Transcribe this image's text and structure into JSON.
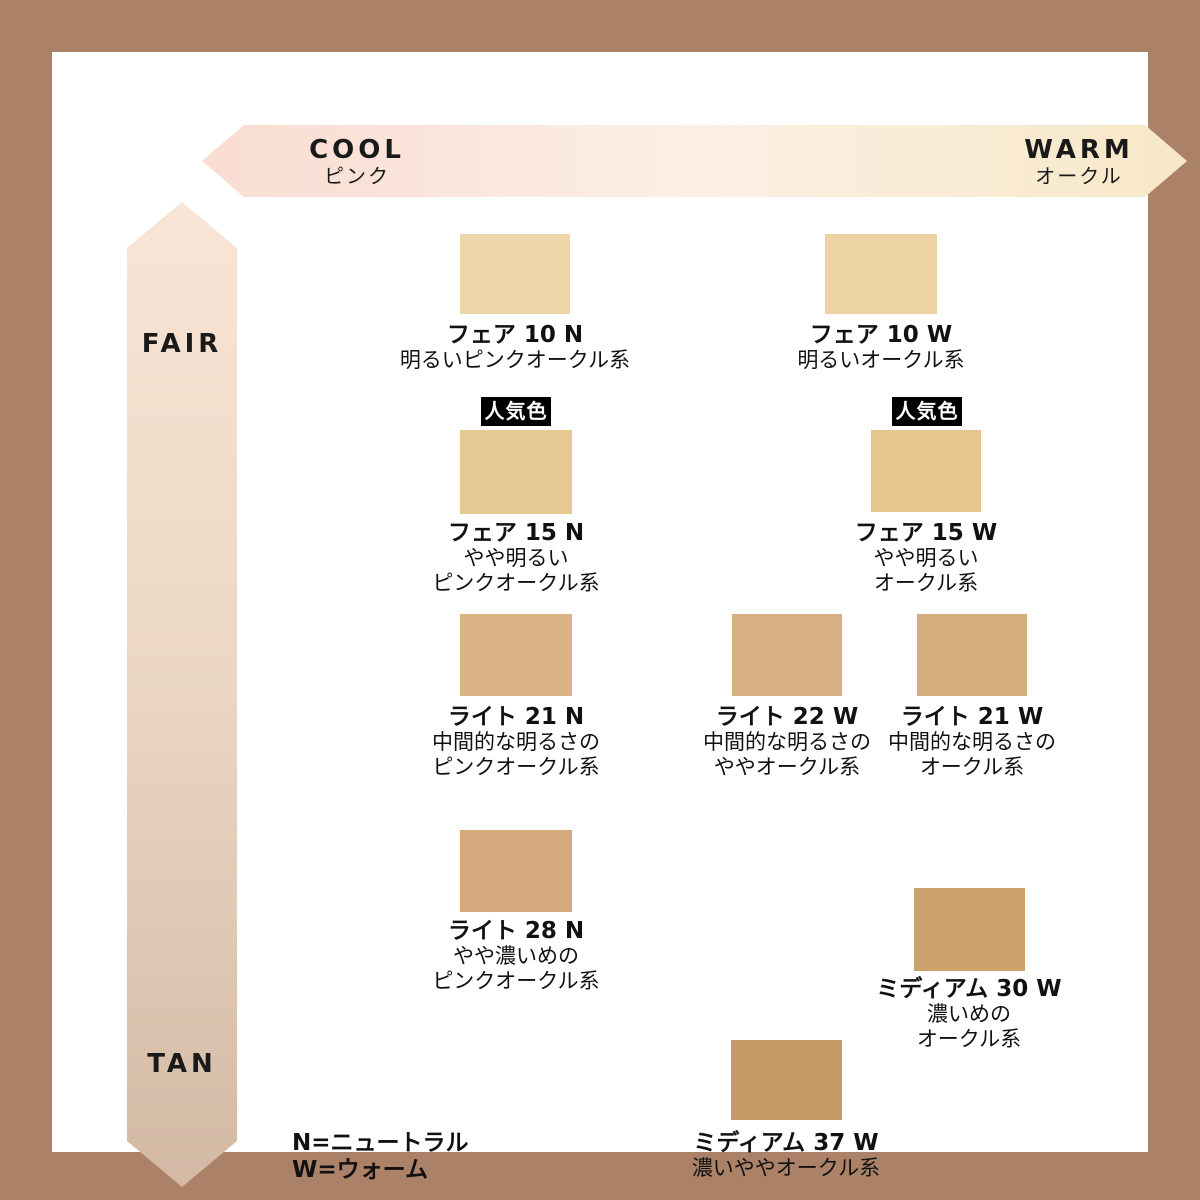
{
  "page": {
    "border_color": "#ab8168",
    "canvas_color": "#ffffff"
  },
  "axes": {
    "horizontal": {
      "left_label": "COOL",
      "left_sublabel": "ピンク",
      "right_label": "WARM",
      "right_sublabel": "オークル",
      "gradient_left": "#f9dcd2",
      "gradient_mid": "#fcefe4",
      "gradient_right": "#f7e8c7"
    },
    "vertical": {
      "top_label": "FAIR",
      "bottom_label": "TAN",
      "gradient_top": "#f8e5d6",
      "gradient_mid": "#ead6c3",
      "gradient_bottom": "#d3b9a4"
    }
  },
  "popular_badge_label": "人気色",
  "legend": {
    "line1": "N=ニュートラル",
    "line2": "W=ウォーム"
  },
  "shades": [
    {
      "name": "フェア 10 N",
      "desc1": "明るいピンクオークル系",
      "color": "#efd5aa",
      "popular": false
    },
    {
      "name": "フェア 10 W",
      "desc1": "明るいオークル系",
      "color": "#edd2a3",
      "popular": false
    },
    {
      "name": "フェア 15 N",
      "desc1": "やや明るい",
      "desc2": "ピンクオークル系",
      "color": "#e7c994",
      "popular": true
    },
    {
      "name": "フェア 15 W",
      "desc1": "やや明るい",
      "desc2": "オークル系",
      "color": "#e5c78d",
      "popular": true
    },
    {
      "name": "ライト 21 N",
      "desc1": "中間的な明るさの",
      "desc2": "ピンクオークル系",
      "color": "#d9b384",
      "popular": false
    },
    {
      "name": "ライト 22 W",
      "desc1": "中間的な明るさの",
      "desc2": "ややオークル系",
      "color": "#d7b183",
      "popular": false
    },
    {
      "name": "ライト 21 W",
      "desc1": "中間的な明るさの",
      "desc2": "オークル系",
      "color": "#d5ae7e",
      "popular": false
    },
    {
      "name": "ライト 28 N",
      "desc1": "やや濃いめの",
      "desc2": "ピンクオークル系",
      "color": "#d5a97b",
      "popular": false
    },
    {
      "name": "ミディアム 30 W",
      "desc1": "濃いめの",
      "desc2": "オークル系",
      "color": "#cda26b",
      "popular": false
    },
    {
      "name": "ミディアム 37 W",
      "desc1": "濃いややオークル系",
      "color": "#c49a66",
      "popular": false
    }
  ]
}
